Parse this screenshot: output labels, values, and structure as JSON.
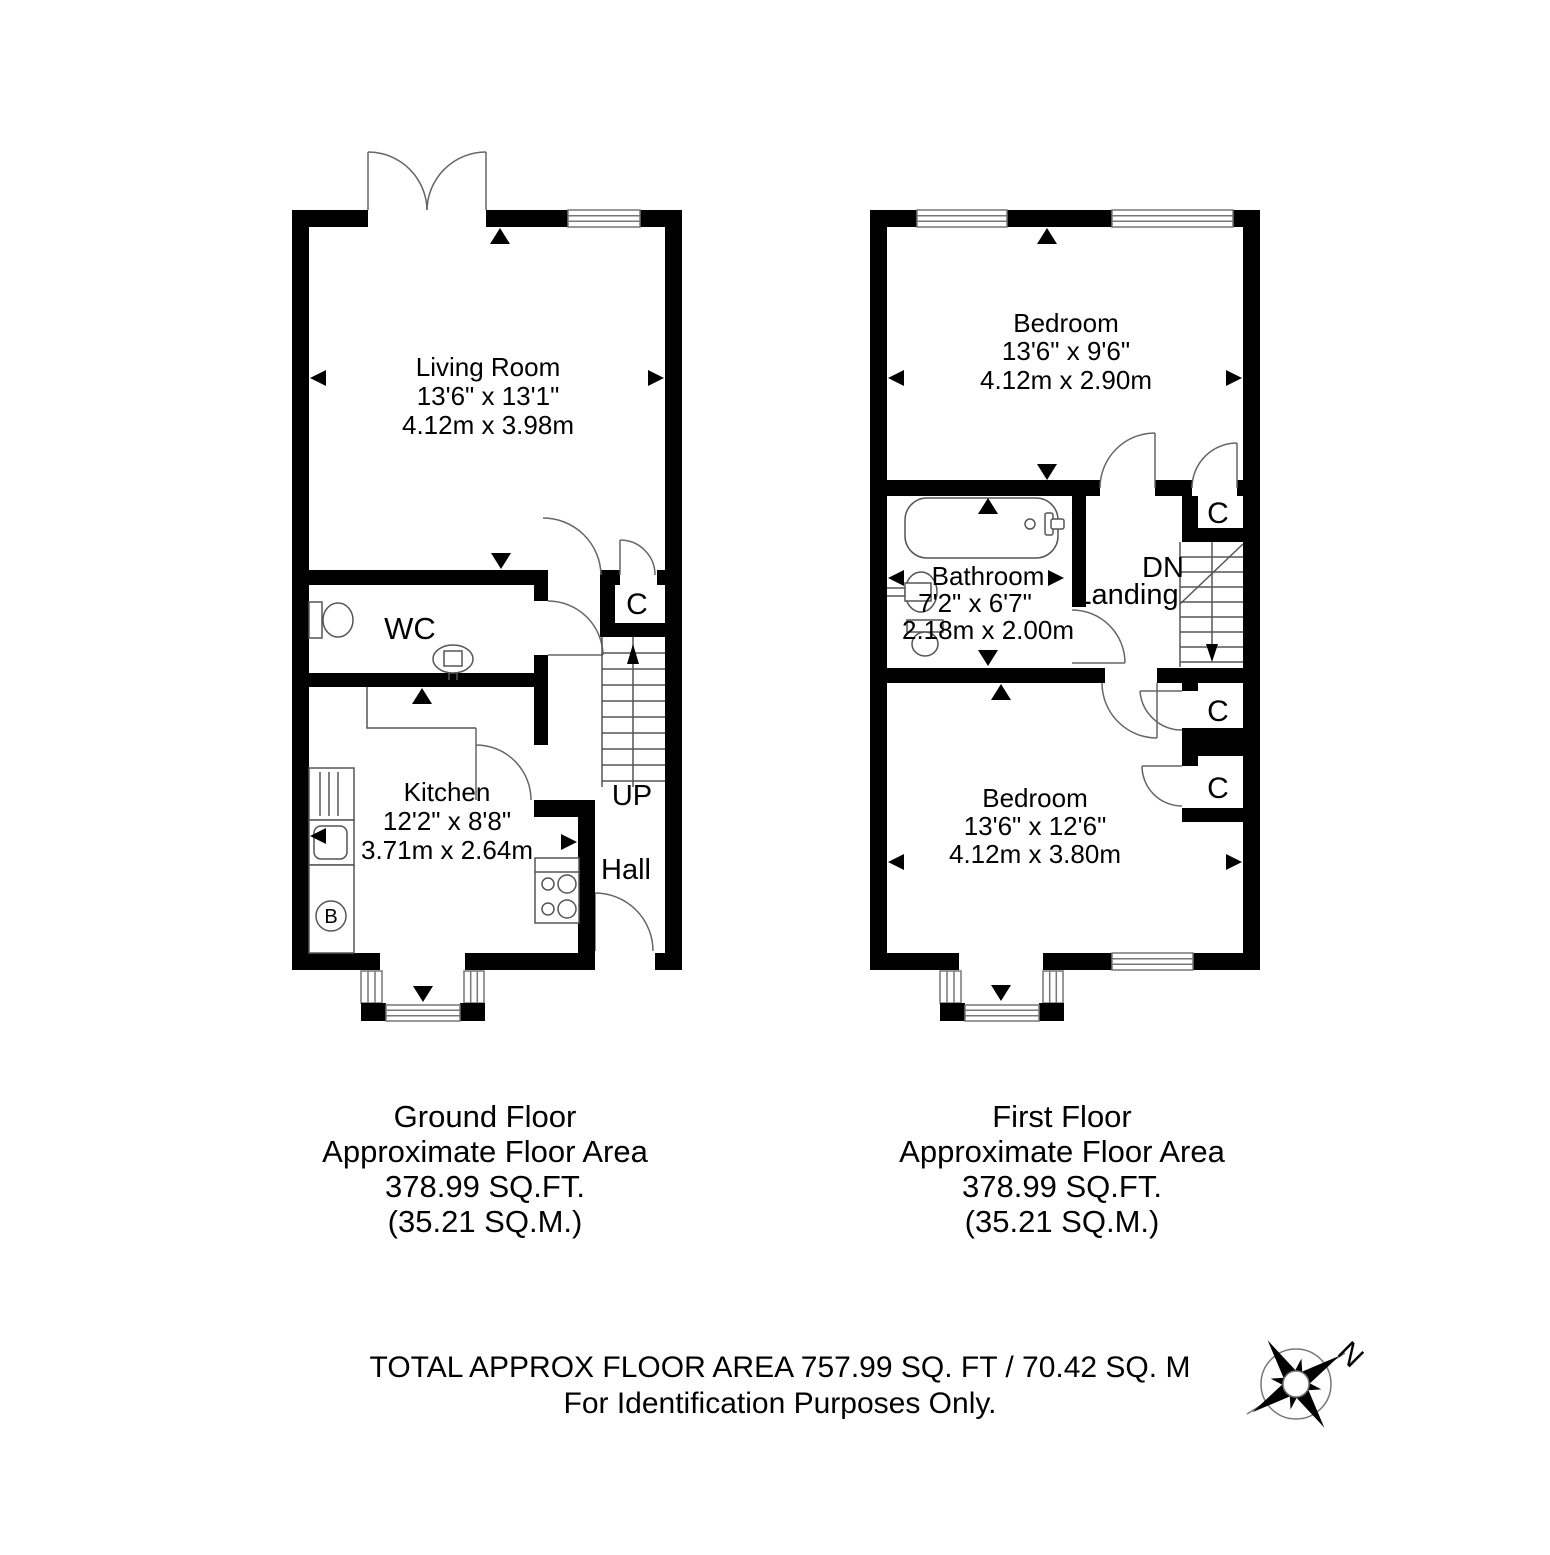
{
  "gf": {
    "living_room": {
      "name": "Living Room",
      "dim_imperial": "13'6\" x 13'1\"",
      "dim_metric": "4.12m x 3.98m"
    },
    "wc_label": "WC",
    "kitchen": {
      "name": "Kitchen",
      "dim_imperial": "12'2\" x 8'8\"",
      "dim_metric": "3.71m x 2.64m"
    },
    "hall_label": "Hall",
    "cupboard_label": "C",
    "stairs_label": "UP",
    "boiler_label": "B",
    "caption": {
      "line1": "Ground Floor",
      "line2": "Approximate Floor Area",
      "line3": "378.99 SQ.FT.",
      "line4": "(35.21 SQ.M.)"
    }
  },
  "ff": {
    "bedroom_front": {
      "name": "Bedroom",
      "dim_imperial": "13'6\" x 9'6\"",
      "dim_metric": "4.12m x 2.90m"
    },
    "bathroom": {
      "name": "Bathroom",
      "dim_imperial": "7'2\" x 6'7\"",
      "dim_metric": "2.18m x 2.00m"
    },
    "bedroom_back": {
      "name": "Bedroom",
      "dim_imperial": "13'6\" x 12'6\"",
      "dim_metric": "4.12m x 3.80m"
    },
    "landing_label": "Landing",
    "stairs_label": "DN",
    "cupboard1_label": "C",
    "cupboard2_label": "C",
    "cupboard3_label": "C",
    "caption": {
      "line1": "First Floor",
      "line2": "Approximate Floor Area",
      "line3": "378.99 SQ.FT.",
      "line4": "(35.21 SQ.M.)"
    }
  },
  "footer": {
    "line1": "TOTAL APPROX FLOOR AREA 757.99 SQ. FT / 70.42 SQ. M",
    "line2": "For Identification Purposes Only."
  },
  "compass": {
    "north_label": "N"
  }
}
